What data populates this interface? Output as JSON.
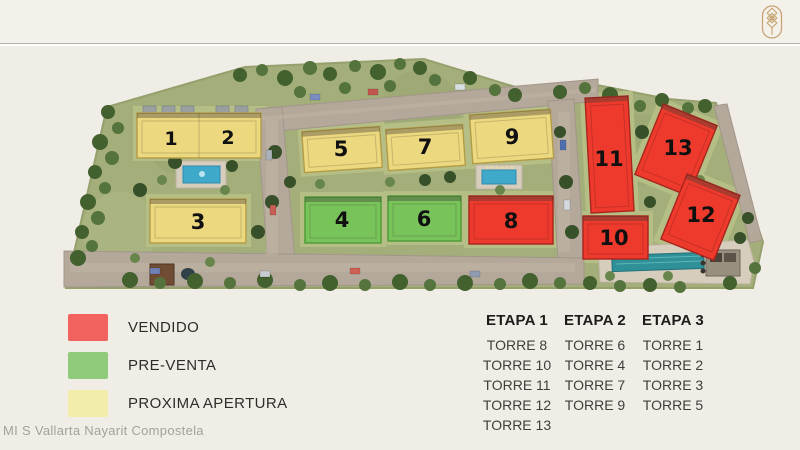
{
  "header": {
    "logo_icon": "brand-emblem-icon"
  },
  "site_plan": {
    "buildings": [
      {
        "number": "1",
        "status": "PROXIMA APERTURA",
        "color": "#ecd87f"
      },
      {
        "number": "2",
        "status": "PROXIMA APERTURA",
        "color": "#ecd87f"
      },
      {
        "number": "3",
        "status": "PROXIMA APERTURA",
        "color": "#ecd87f"
      },
      {
        "number": "4",
        "status": "PRE-VENTA",
        "color": "#79c35b"
      },
      {
        "number": "5",
        "status": "PROXIMA APERTURA",
        "color": "#ecd87f"
      },
      {
        "number": "6",
        "status": "PRE-VENTA",
        "color": "#79c35b"
      },
      {
        "number": "7",
        "status": "PROXIMA APERTURA",
        "color": "#ecd87f"
      },
      {
        "number": "8",
        "status": "VENDIDO",
        "color": "#ee3a2d"
      },
      {
        "number": "9",
        "status": "PROXIMA APERTURA",
        "color": "#ecd87f"
      },
      {
        "number": "10",
        "status": "VENDIDO",
        "color": "#ee3a2d"
      },
      {
        "number": "11",
        "status": "VENDIDO",
        "color": "#ee3a2d"
      },
      {
        "number": "12",
        "status": "VENDIDO",
        "color": "#ee3a2d"
      },
      {
        "number": "13",
        "status": "VENDIDO",
        "color": "#ee3a2d"
      }
    ]
  },
  "legend": {
    "items": [
      {
        "label": "VENDIDO",
        "color": "#f2635f"
      },
      {
        "label": "PRE-VENTA",
        "color": "#90cb7b"
      },
      {
        "label": "PROXIMA APERTURA",
        "color": "#f2eda9"
      }
    ]
  },
  "etapas": [
    {
      "title": "ETAPA 1",
      "towers": [
        "TORRE 8",
        "TORRE 10",
        "TORRE 11",
        "TORRE 12",
        "TORRE 13"
      ]
    },
    {
      "title": "ETAPA 2",
      "towers": [
        "TORRE 6",
        "TORRE 4",
        "TORRE 7",
        "TORRE 9"
      ]
    },
    {
      "title": "ETAPA 3",
      "towers": [
        "TORRE 1",
        "TORRE 2",
        "TORRE 3",
        "TORRE 5"
      ]
    }
  ],
  "watermark": "MI S Vallarta Nayarit Compostela"
}
